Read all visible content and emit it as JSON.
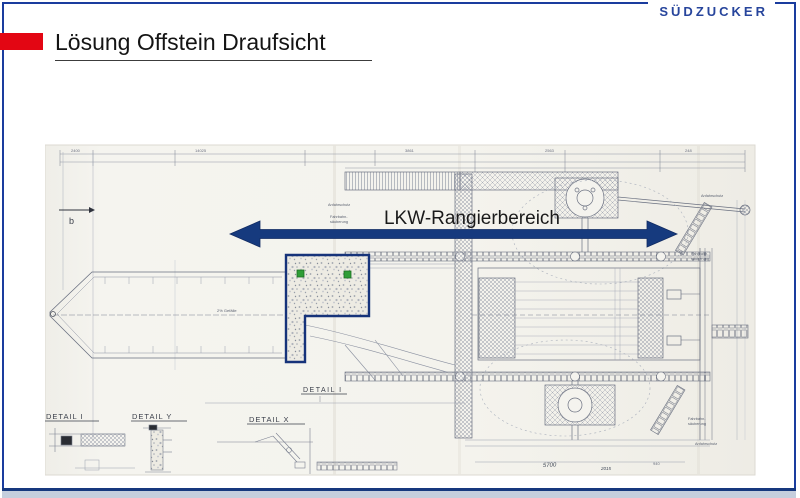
{
  "slide": {
    "logo_text": "SÜDZUCKER",
    "title": "Lösung Offstein Draufsicht",
    "colors": {
      "brand_red": "#E30613",
      "frame_blue": "#1A3C9E",
      "overlay_navy": "#163A7E",
      "marker_green": "#2F9E36",
      "footer_band": "#C5CEDD"
    }
  },
  "overlay": {
    "arrow_label": "LKW-Rangierbereich"
  },
  "drawing": {
    "detail_labels": [
      "DETAIL I",
      "DETAIL Y",
      "DETAIL X",
      "DETAIL I"
    ],
    "section_letter": "b",
    "slope_label": "2% Gefälle",
    "anfahrschutz": "Anfahrschutz",
    "fahrbahn_1": "Fahrbahn-",
    "fahrbahn_2": "säuberung",
    "dims": {
      "d1": "2400",
      "d2": "14025",
      "d3": "3861",
      "d4": "2563",
      "d5": "248",
      "d6": "5700",
      "d7": "2015",
      "d8": "940"
    }
  }
}
